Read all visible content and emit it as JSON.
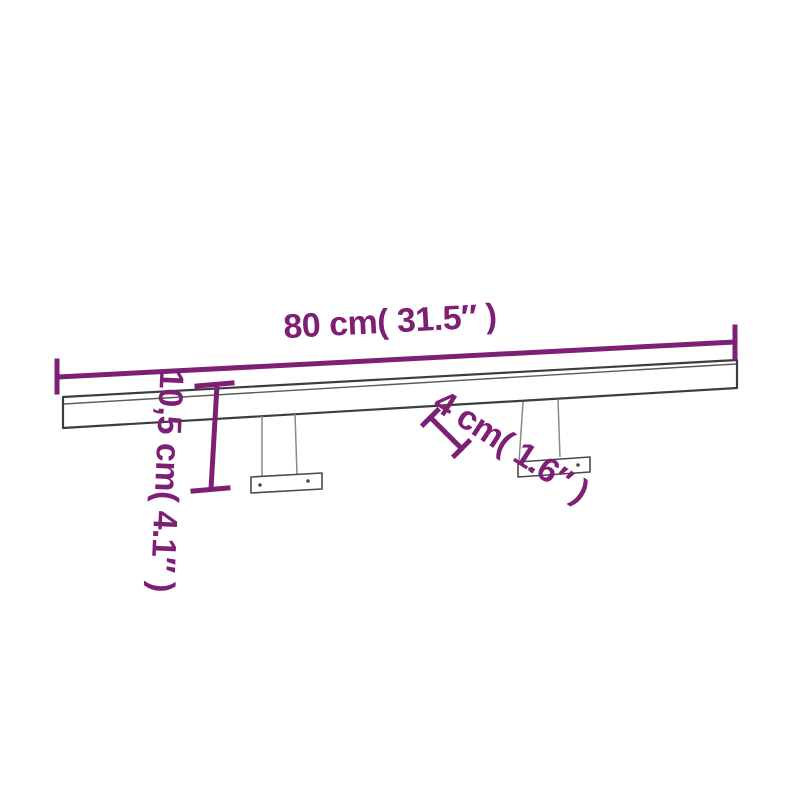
{
  "diagram": {
    "dimensions": {
      "length": {
        "label": "80 cm( 31.5″ )"
      },
      "height": {
        "label": "10,5 cm( 4.1″ )"
      },
      "depth": {
        "label": "4 cm( 1.6″ )"
      }
    }
  },
  "colors": {
    "dimension": "#7E1F76",
    "outline": "#3D3D3D",
    "seam": "#5A5A5A",
    "bracket": "#8A8A8A",
    "plate_outline": "#4A4A4A",
    "screw": "#4A4A4A",
    "background": "#FFFFFF"
  }
}
